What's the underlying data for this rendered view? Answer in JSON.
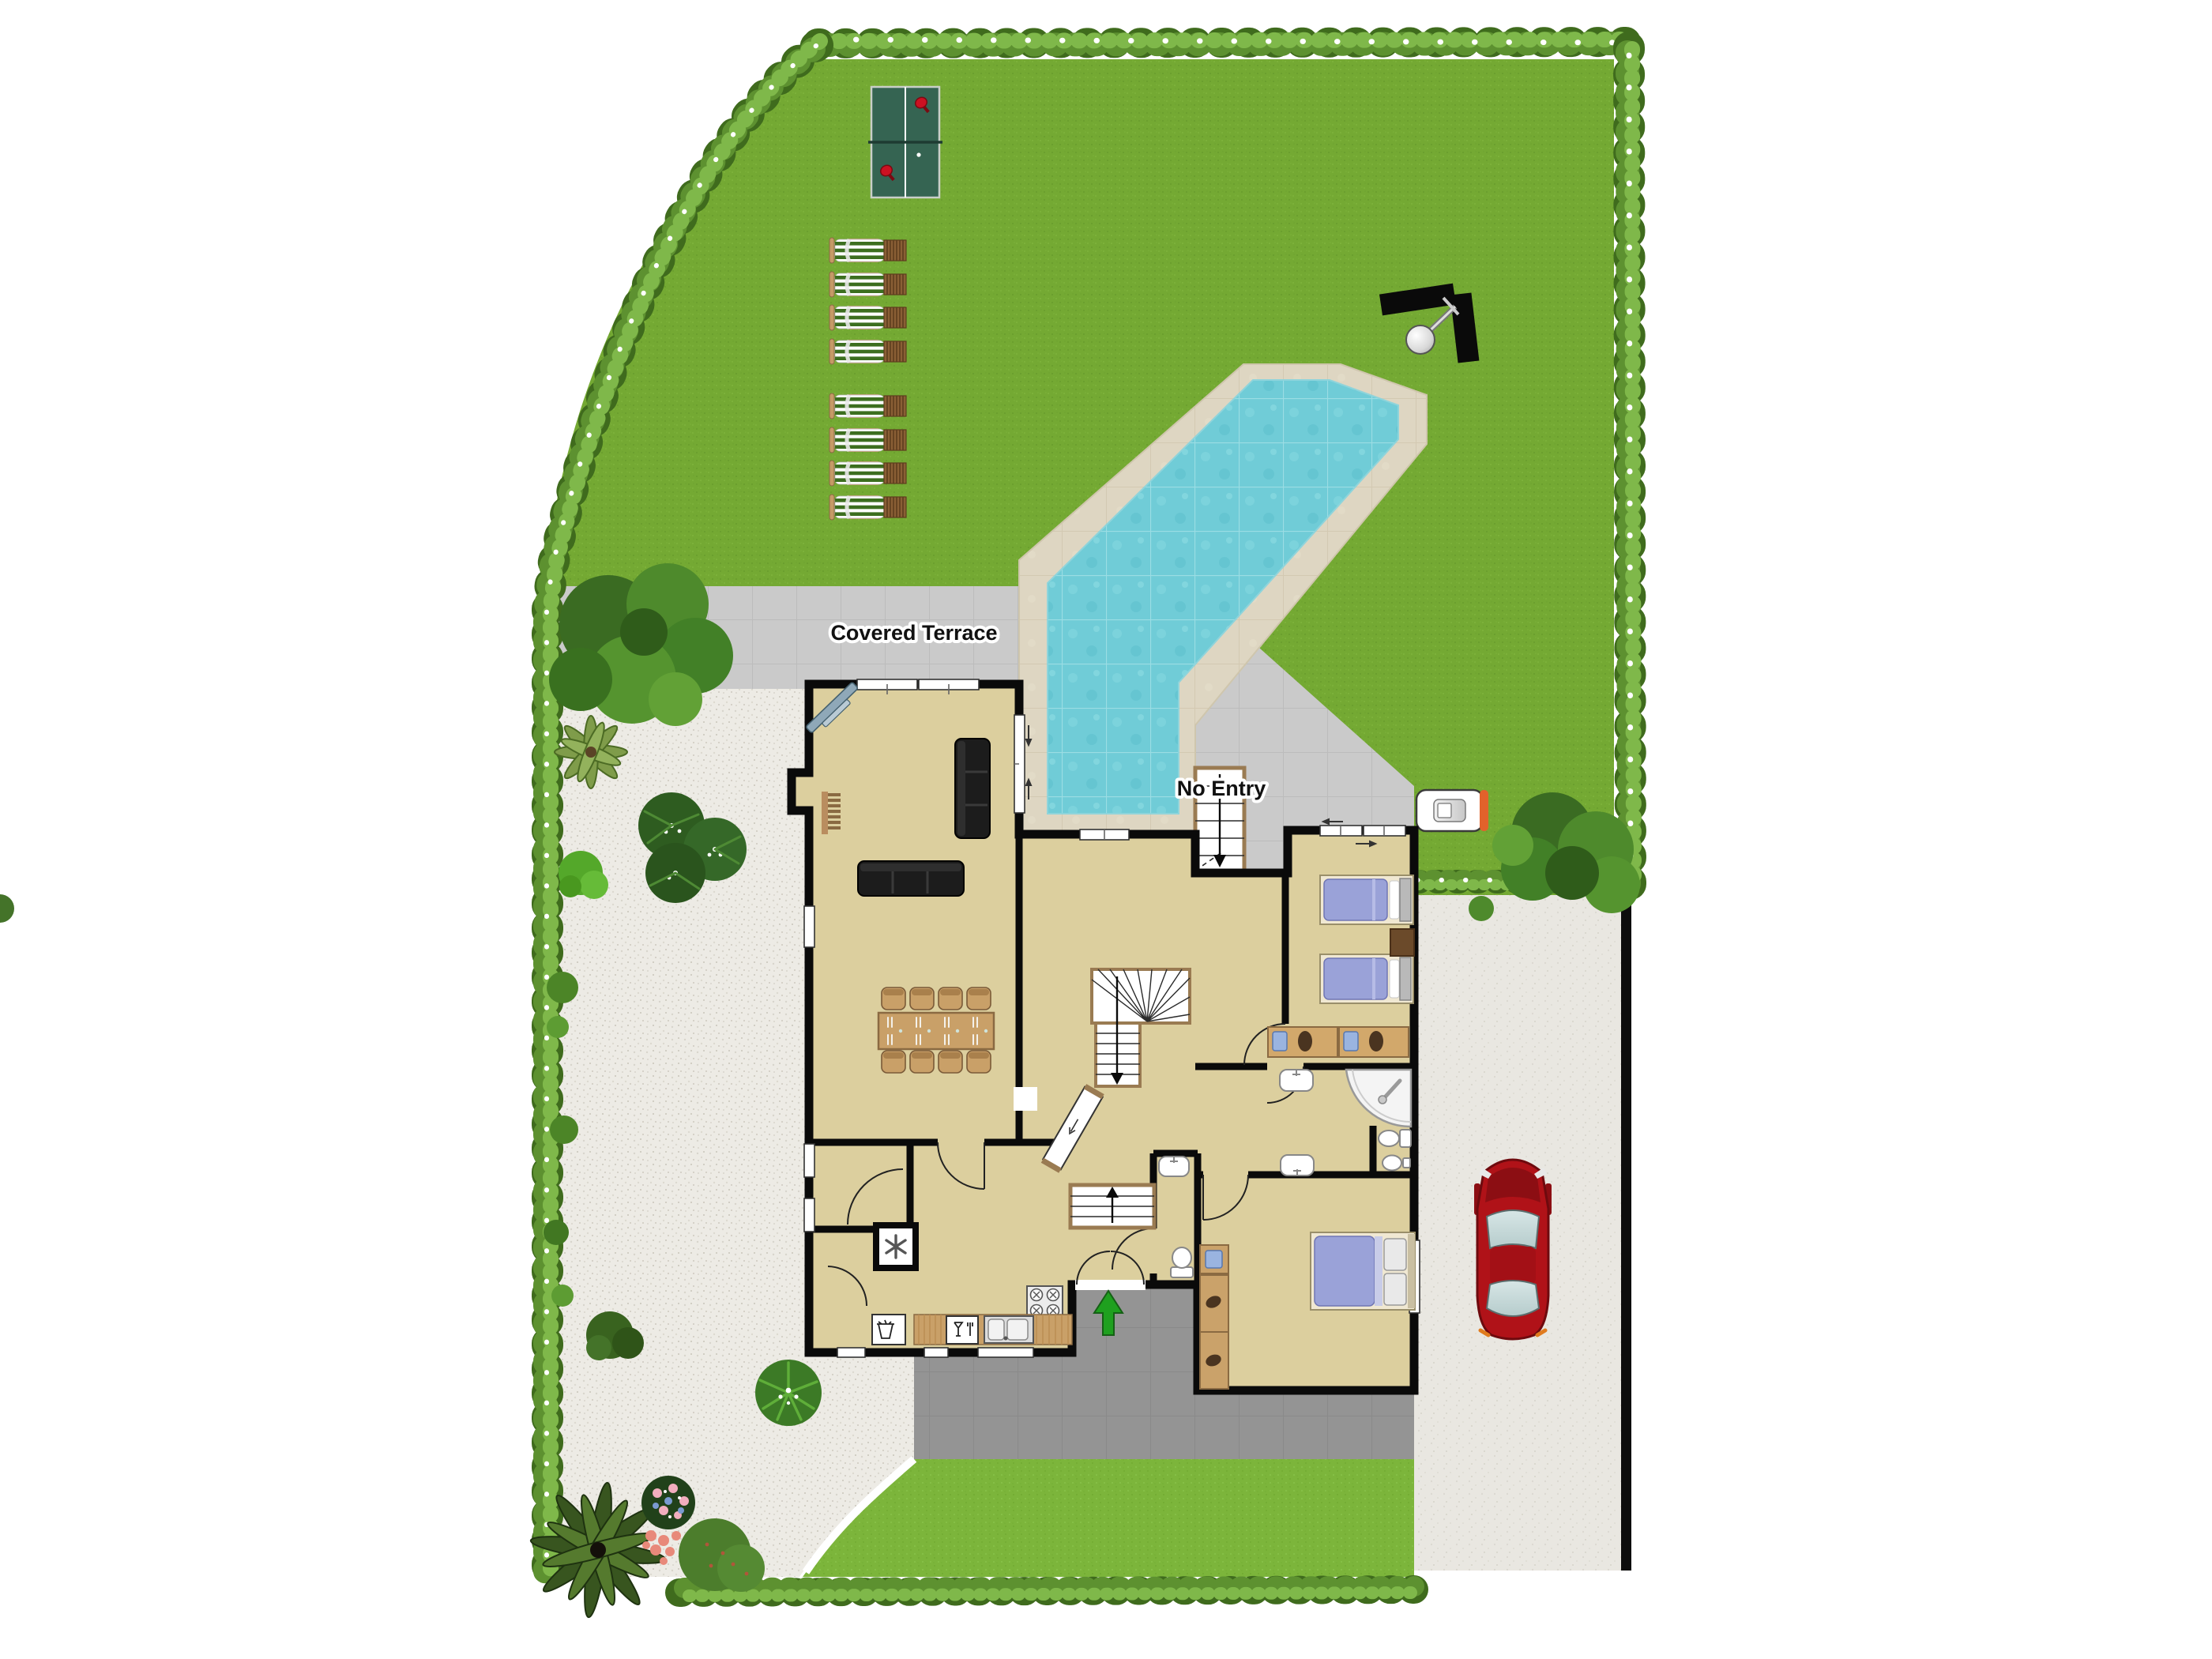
{
  "scene": {
    "kind": "residential site / floor plan, top-down",
    "labels": {
      "covered_terrace": "Covered Terrace",
      "no_entry": "No Entry"
    }
  },
  "counts": {
    "sun_loungers": 8,
    "dining_chairs": 8,
    "table_tennis_paddles": 2,
    "single_beds": 2,
    "double_beds": 1,
    "cars": 1
  },
  "colors": {
    "lawn": "#74a933",
    "lower_lawn": "#7cb53b",
    "hedge_dark": "#3f6b1d",
    "hedge_mid": "#5d9130",
    "hedge_light": "#7fb84a",
    "pool_water": "#70ccd7",
    "pool_deck": "#ded6c2",
    "terrace_tile": "#cacaca",
    "entrance_path": "#949494",
    "gravel": "#edebe5",
    "driveway": "#e9e7e1",
    "house_floor": "#dccf9e",
    "wall": "#0a0a0a",
    "wood": "#c9a068",
    "bed_blanket": "#9aa2d8",
    "sofa_black": "#1c1c1c",
    "car_red": "#b01218",
    "entrance_arrow_green": "#1fa01f",
    "table_tennis_green": "#356452",
    "lounger_stripe_green": "#3c6e1f",
    "intercom_accent_orange": "#e2622b"
  },
  "objects": [
    "table-tennis-table",
    "sun-loungers",
    "swimming-pool",
    "pool-shower",
    "covered-terrace",
    "no-entry-stairs",
    "intercom-unit",
    "red-car",
    "driveway",
    "living-room-sofas",
    "corner-tv",
    "radiator",
    "dining-table",
    "winder-staircase",
    "entry-stairs",
    "entrance-double-door",
    "entrance-arrow",
    "kitchen-stove",
    "kitchen-sink",
    "dishwasher",
    "washing-machine",
    "freezer",
    "twin-beds",
    "double-bed",
    "wardrobe",
    "desks",
    "corner-shower",
    "toilets",
    "sinks",
    "hedges",
    "trees",
    "flower-beds"
  ]
}
